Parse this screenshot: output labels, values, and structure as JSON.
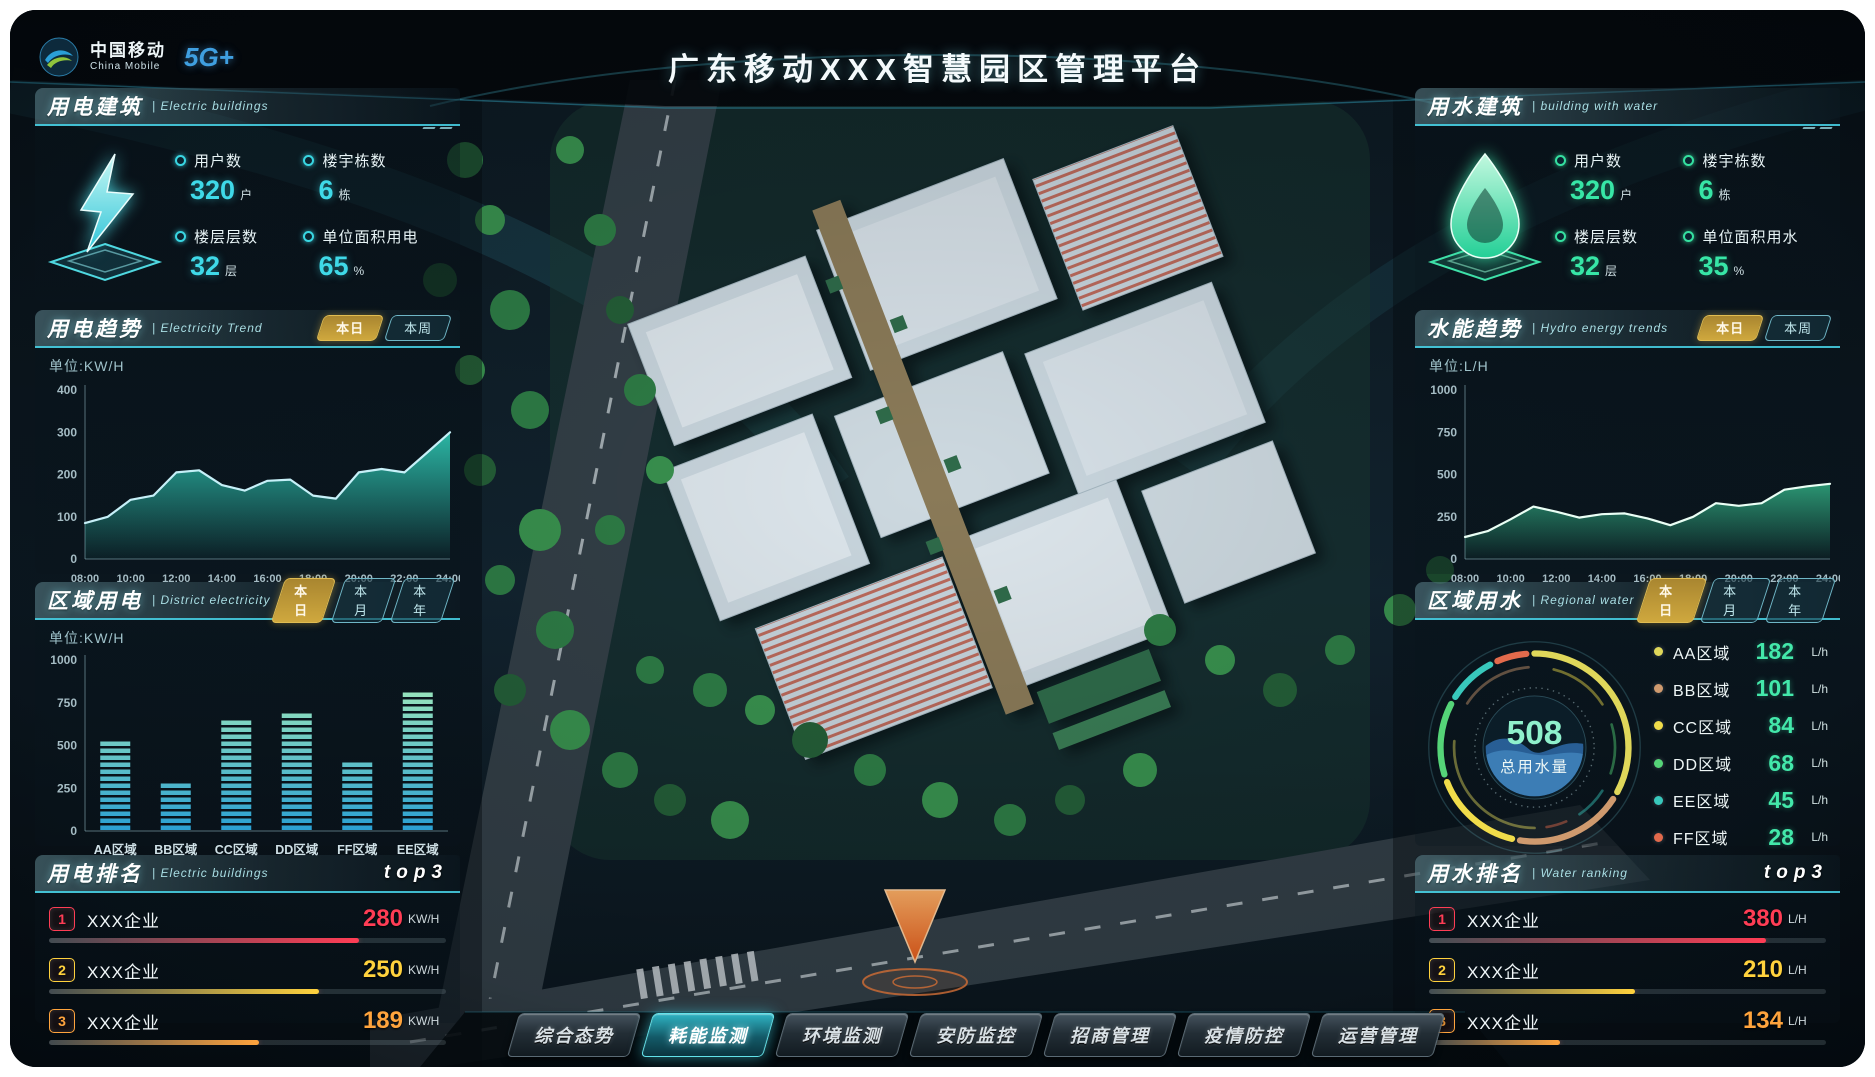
{
  "header": {
    "title": "广东移动XXX智慧园区管理平台",
    "logo_cn": "中国移动",
    "logo_en": "China Mobile",
    "logo_badge": "5G+"
  },
  "panels": {
    "electric_building": {
      "title": "用电建筑",
      "subtitle": "| Electric buildings",
      "stats": [
        {
          "label": "用户数",
          "value": "320",
          "unit": "户"
        },
        {
          "label": "楼宇栋数",
          "value": "6",
          "unit": "栋"
        },
        {
          "label": "楼层层数",
          "value": "32",
          "unit": "层"
        },
        {
          "label": "单位面积用电",
          "value": "65",
          "unit": "%"
        }
      ]
    },
    "electric_trend": {
      "title": "用电趋势",
      "subtitle": "| Electricity Trend",
      "unit": "单位:KW/H",
      "tabs": [
        "本日",
        "本周"
      ]
    },
    "district_electric": {
      "title": "区域用电",
      "subtitle": "| District electricity",
      "unit": "单位:KW/H",
      "tabs": [
        "本日",
        "本月",
        "本年"
      ]
    },
    "electric_rank": {
      "title": "用电排名",
      "subtitle": "| Electric buildings",
      "badge": "top3",
      "rows": [
        {
          "rank": "1",
          "name": "XXX企业",
          "value": "280",
          "unit": "KW/H",
          "pct": 78,
          "color": "#ff3d55"
        },
        {
          "rank": "2",
          "name": "XXX企业",
          "value": "250",
          "unit": "KW/H",
          "pct": 68,
          "color": "#ffd23d"
        },
        {
          "rank": "3",
          "name": "XXX企业",
          "value": "189",
          "unit": "KW/H",
          "pct": 53,
          "color": "#ffa43d"
        }
      ]
    },
    "water_building": {
      "title": "用水建筑",
      "subtitle": "| building with water",
      "stats": [
        {
          "label": "用户数",
          "value": "320",
          "unit": "户"
        },
        {
          "label": "楼宇栋数",
          "value": "6",
          "unit": "栋"
        },
        {
          "label": "楼层层数",
          "value": "32",
          "unit": "层"
        },
        {
          "label": "单位面积用水",
          "value": "35",
          "unit": "%"
        }
      ]
    },
    "water_trend": {
      "title": "水能趋势",
      "subtitle": "| Hydro energy trends",
      "unit": "单位:L/H",
      "tabs": [
        "本日",
        "本周"
      ]
    },
    "regional_water": {
      "title": "区域用水",
      "subtitle": "| Regional water",
      "tabs": [
        "本日",
        "本月",
        "本年"
      ],
      "total_value": "508",
      "total_label": "总用水量",
      "legend": [
        {
          "name": "AA区域",
          "value": "182",
          "unit": "L/h",
          "color": "#dfd75a"
        },
        {
          "name": "BB区域",
          "value": "101",
          "unit": "L/h",
          "color": "#cf9a6e"
        },
        {
          "name": "CC区域",
          "value": "84",
          "unit": "L/h",
          "color": "#f0dc4a"
        },
        {
          "name": "DD区域",
          "value": "68",
          "unit": "L/h",
          "color": "#55d478"
        },
        {
          "name": "EE区域",
          "value": "45",
          "unit": "L/h",
          "color": "#38c8bc"
        },
        {
          "name": "FF区域",
          "value": "28",
          "unit": "L/h",
          "color": "#e26a4c"
        }
      ]
    },
    "water_rank": {
      "title": "用水排名",
      "subtitle": "| Water ranking",
      "badge": "top3",
      "rows": [
        {
          "rank": "1",
          "name": "XXX企业",
          "value": "380",
          "unit": "L/H",
          "pct": 85,
          "color": "#ff3d55"
        },
        {
          "rank": "2",
          "name": "XXX企业",
          "value": "210",
          "unit": "L/H",
          "pct": 52,
          "color": "#ffd23d"
        },
        {
          "rank": "3",
          "name": "XXX企业",
          "value": "134",
          "unit": "L/H",
          "pct": 33,
          "color": "#ffa43d"
        }
      ]
    }
  },
  "nav": {
    "items": [
      "综合态势",
      "耗能监测",
      "环境监测",
      "安防监控",
      "招商管理",
      "疫情防控",
      "运营管理"
    ],
    "active_index": 1
  },
  "chart_data": [
    {
      "id": "chart-electric",
      "type": "area",
      "title": "用电趋势",
      "ylabel": "单位:KW/H",
      "ylim": [
        0,
        400
      ],
      "y_ticks": [
        0,
        100,
        200,
        300,
        400
      ],
      "x_ticks": [
        "08:00",
        "10:00",
        "12:00",
        "14:00",
        "16:00",
        "18:00",
        "20:00",
        "22:00",
        "24:00"
      ],
      "values": [
        85,
        100,
        140,
        150,
        205,
        210,
        175,
        162,
        185,
        188,
        150,
        143,
        205,
        213,
        205,
        252,
        300
      ],
      "line_color": "#c6f0f8",
      "fill_top": "#2fc8b4"
    },
    {
      "id": "chart-district",
      "type": "bar",
      "title": "区域用电",
      "ylabel": "单位:KW/H",
      "ylim": [
        0,
        1000
      ],
      "y_ticks": [
        0,
        250,
        500,
        750,
        1000
      ],
      "categories": [
        "AA区域",
        "BB区域",
        "CC区域",
        "DD区域",
        "FF区域",
        "EE区域"
      ],
      "values": [
        560,
        290,
        690,
        720,
        420,
        850
      ],
      "bar_top": "#aef2b8",
      "bar_bottom": "#2a9fd2"
    },
    {
      "id": "chart-water",
      "type": "area",
      "title": "水能趋势",
      "ylabel": "单位:L/H",
      "ylim": [
        0,
        1000
      ],
      "y_ticks": [
        0,
        250,
        500,
        750,
        1000
      ],
      "x_ticks": [
        "08:00",
        "10:00",
        "12:00",
        "14:00",
        "16:00",
        "18:00",
        "20:00",
        "22:00",
        "24:00"
      ],
      "values": [
        130,
        165,
        235,
        310,
        280,
        245,
        265,
        270,
        240,
        200,
        250,
        330,
        315,
        330,
        410,
        430,
        445
      ],
      "line_color": "#eafff5",
      "fill_top": "#2fa37c"
    },
    {
      "id": "donut-water",
      "type": "pie",
      "title": "区域用水",
      "center_value": "508",
      "center_label": "总用水量",
      "segments": [
        {
          "name": "AA区域",
          "value": 182,
          "color": "#dfd75a"
        },
        {
          "name": "BB区域",
          "value": 101,
          "color": "#cf9a6e"
        },
        {
          "name": "CC区域",
          "value": 84,
          "color": "#f0dc4a"
        },
        {
          "name": "DD区域",
          "value": 68,
          "color": "#55d478"
        },
        {
          "name": "EE区域",
          "value": 45,
          "color": "#38c8bc"
        },
        {
          "name": "FF区域",
          "value": 28,
          "color": "#e26a4c"
        }
      ]
    }
  ]
}
